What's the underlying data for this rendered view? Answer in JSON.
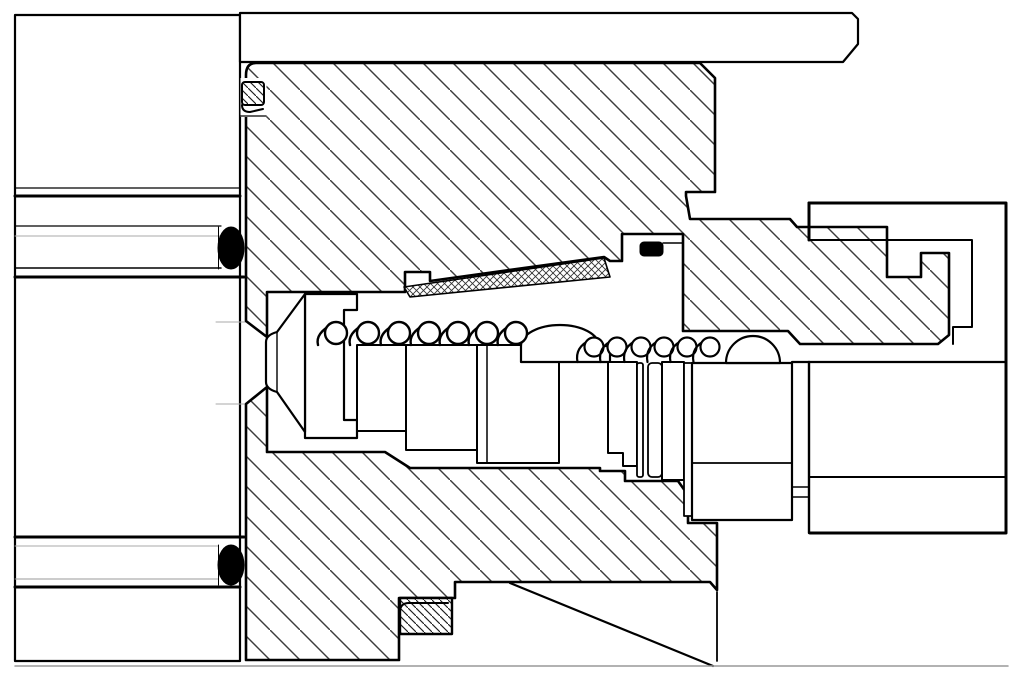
{
  "drawing": {
    "canvas": {
      "width": 1024,
      "height": 681,
      "background": "#ffffff"
    },
    "colors": {
      "line": "#000000",
      "hatch": "#3c3c3c",
      "light_gray": "#aaaaaa",
      "frame_gray": "#999999",
      "seal_black": "#000000",
      "paper": "#ffffff"
    },
    "springs": [
      {
        "name": "spring-left",
        "cy": 333,
        "r": 11,
        "base_y": 345,
        "cx": [
          336,
          368,
          399,
          429,
          458,
          487,
          516
        ],
        "stroke_w": 2.4
      },
      {
        "name": "spring-right",
        "cy": 347,
        "r": 9.5,
        "base_y": 362,
        "cx": [
          594,
          617,
          641,
          664,
          687,
          710
        ],
        "stroke_w": 2.2
      }
    ],
    "parts": [
      {
        "name": "manifold-block",
        "kind": "path",
        "d": "M15,15 H240 V661 H15 Z",
        "fill": "#ffffff",
        "stroke": "#000000",
        "w": 2.2
      },
      {
        "name": "manifold-line-1",
        "kind": "line",
        "x1": 15,
        "y1": 188,
        "x2": 240,
        "y2": 188,
        "stroke": "#000000",
        "w": 1.2
      },
      {
        "name": "manifold-line-2",
        "kind": "line",
        "x1": 15,
        "y1": 196,
        "x2": 240,
        "y2": 196,
        "stroke": "#000000",
        "w": 3
      },
      {
        "name": "manifold-line-3",
        "kind": "line",
        "x1": 15,
        "y1": 226,
        "x2": 221,
        "y2": 226,
        "stroke": "#000000",
        "w": 1.2
      },
      {
        "name": "manifold-line-4",
        "kind": "line",
        "x1": 15,
        "y1": 236,
        "x2": 221,
        "y2": 236,
        "stroke": "#aaaaaa",
        "w": 1
      },
      {
        "name": "manifold-line-5",
        "kind": "line",
        "x1": 15,
        "y1": 268,
        "x2": 221,
        "y2": 268,
        "stroke": "#000000",
        "w": 1.5
      },
      {
        "name": "manifold-line-6",
        "kind": "line",
        "x1": 15,
        "y1": 277,
        "x2": 244,
        "y2": 277,
        "stroke": "#000000",
        "w": 3
      },
      {
        "name": "manifold-line-7",
        "kind": "line",
        "x1": 15,
        "y1": 537,
        "x2": 244,
        "y2": 537,
        "stroke": "#000000",
        "w": 3
      },
      {
        "name": "manifold-line-8",
        "kind": "line",
        "x1": 15,
        "y1": 546,
        "x2": 218,
        "y2": 546,
        "stroke": "#aaaaaa",
        "w": 1
      },
      {
        "name": "manifold-line-9",
        "kind": "line",
        "x1": 15,
        "y1": 579,
        "x2": 218,
        "y2": 579,
        "stroke": "#999999",
        "w": 1
      },
      {
        "name": "manifold-line-10",
        "kind": "line",
        "x1": 15,
        "y1": 587,
        "x2": 240,
        "y2": 587,
        "stroke": "#000000",
        "w": 3
      },
      {
        "name": "port-edge-upper",
        "kind": "line",
        "x1": 216,
        "y1": 322,
        "x2": 246,
        "y2": 322,
        "stroke": "#aaaaaa",
        "w": 1
      },
      {
        "name": "port-edge-lower",
        "kind": "line",
        "x1": 216,
        "y1": 404,
        "x2": 246,
        "y2": 404,
        "stroke": "#aaaaaa",
        "w": 1
      },
      {
        "name": "oring-groove-upper",
        "kind": "line",
        "x1": 218.5,
        "y1": 227,
        "x2": 218.5,
        "y2": 269,
        "stroke": "#000000",
        "w": 1
      },
      {
        "name": "oring-groove-lower",
        "kind": "line",
        "x1": 218.5,
        "y1": 545,
        "x2": 218.5,
        "y2": 585,
        "stroke": "#000000",
        "w": 1
      },
      {
        "name": "top-cover-strip",
        "kind": "path",
        "d": "M240,13 H852 L858,19 V44 L843,62 H240 Z",
        "fill": "#ffffff",
        "stroke": "#000000",
        "w": 2.2
      },
      {
        "name": "valve-body-upper-half",
        "kind": "path",
        "d": "M256,63 H700 L715,78 V192 H686 V196 L690,219 H790 L797,227 H887 V277 H921 V253 H949 V335 L938,344 H800 L788,331 H683 V234 H622 V261 H610 L604,257 L430,281 V272 H405 V292 H267 V337 L246,321 V75 Q246,63 256,63 Z",
        "fill": "url(#hatchMain)",
        "stroke": "#000000",
        "w": 2.6
      },
      {
        "name": "valve-body-lower-half",
        "kind": "path",
        "d": "M246,404 L267,387 V452 H385 L410,468 H600 V471 H625 V481 H678 L688,495 V523 H717 V590 L710,582 H455 V598 H399 V660 H246 Z",
        "fill": "url(#hatchMain)",
        "stroke": "#000000",
        "w": 2.6
      },
      {
        "name": "bore-curve-edge",
        "kind": "line",
        "x1": 510,
        "y1": 583,
        "x2": 713,
        "y2": 666,
        "stroke": "#000000",
        "w": 2.2
      },
      {
        "name": "body-rear-edge",
        "kind": "line",
        "x1": 717,
        "y1": 592,
        "x2": 717,
        "y2": 661,
        "stroke": "#000000",
        "w": 1.8
      },
      {
        "name": "baseline",
        "kind": "line",
        "x1": 15,
        "y1": 666,
        "x2": 1008,
        "y2": 666,
        "stroke": "#999999",
        "w": 1.5
      },
      {
        "name": "spring-cup",
        "kind": "path",
        "d": "M305,294 H357 V310 H344 V420 H357 V438 H305 Z",
        "fill": "#ffffff",
        "stroke": "#000000",
        "w": 2.2
      },
      {
        "name": "poppet",
        "kind": "path",
        "d": "M305,294 L277,332 Q266,335 266,342 V382 Q266,389 277,392 L305,432 Z",
        "fill": "#ffffff",
        "stroke": "#000000",
        "w": 2.2
      },
      {
        "name": "poppet-tip-edge",
        "kind": "line",
        "x1": 277,
        "y1": 332,
        "x2": 277,
        "y2": 392,
        "stroke": "#000000",
        "w": 1.4
      },
      {
        "name": "spool-segment-1",
        "kind": "rect",
        "x": 357,
        "y": 345,
        "width": 49,
        "height": 86,
        "fill": "#ffffff",
        "stroke": "#000000",
        "w": 2
      },
      {
        "name": "spool-segment-2",
        "kind": "rect",
        "x": 406,
        "y": 345,
        "width": 71,
        "height": 105,
        "fill": "#ffffff",
        "stroke": "#000000",
        "w": 2
      },
      {
        "name": "spool-segment-3",
        "kind": "rect",
        "x": 477,
        "y": 345,
        "width": 82,
        "height": 118,
        "fill": "#ffffff",
        "stroke": "#000000",
        "w": 2
      },
      {
        "name": "spool-rib-edge",
        "kind": "line",
        "x1": 487,
        "y1": 345,
        "x2": 487,
        "y2": 463,
        "stroke": "#000000",
        "w": 1.5
      },
      {
        "name": "spool-dome-left",
        "kind": "path",
        "d": "M521,346 A39,21 0 0 1 599,346 H610 V362 H521 Z",
        "fill": "#ffffff",
        "stroke": "#000000",
        "w": 2.2
      },
      {
        "name": "spool-segment-4",
        "kind": "path",
        "d": "M608,362 H637 V466 H623 V453 H608 Z",
        "fill": "#ffffff",
        "stroke": "#000000",
        "w": 2
      },
      {
        "name": "retaining-ring-a",
        "kind": "rect",
        "x": 637,
        "y": 363,
        "width": 6,
        "height": 114,
        "rx": 2,
        "fill": "#ffffff",
        "stroke": "#000000",
        "w": 1.8
      },
      {
        "name": "retaining-ring-b",
        "kind": "rect",
        "x": 648,
        "y": 363,
        "width": 14,
        "height": 114,
        "rx": 4,
        "fill": "#ffffff",
        "stroke": "#000000",
        "w": 1.8
      },
      {
        "name": "spool-segment-5",
        "kind": "rect",
        "x": 662,
        "y": 362,
        "width": 22,
        "height": 118,
        "fill": "#ffffff",
        "stroke": "#000000",
        "w": 2
      },
      {
        "name": "spool-sleeve-strip",
        "kind": "rect",
        "x": 684,
        "y": 363,
        "width": 8,
        "height": 153,
        "fill": "#ffffff",
        "stroke": "#000000",
        "w": 1.8
      },
      {
        "name": "spool-segment-6",
        "kind": "path",
        "d": "M692,363 H792 V520 H692 Z",
        "fill": "#ffffff",
        "stroke": "#000000",
        "w": 2.2
      },
      {
        "name": "spool-segment-6-step",
        "kind": "line",
        "x1": 692,
        "y1": 463,
        "x2": 792,
        "y2": 463,
        "stroke": "#000000",
        "w": 1.8
      },
      {
        "name": "spool-dome-right",
        "kind": "path",
        "d": "M726,363 A27,27 0 0 1 780,363 Z",
        "fill": "#ffffff",
        "stroke": "#000000",
        "w": 2.2
      },
      {
        "name": "metering-wedge",
        "kind": "path",
        "d": "M404,287 L604,258 L610,277 L410,297 Z",
        "fill": "url(#crossFine)",
        "stroke": "#000000",
        "w": 1.6
      },
      {
        "name": "wedge-step-edge",
        "kind": "path",
        "d": "M405,272 H430 V281",
        "fill": "none",
        "stroke": "#000000",
        "w": 1.4
      },
      {
        "name": "upper-seal-groove",
        "kind": "rect",
        "x": 240.5,
        "y": 78,
        "width": 26,
        "height": 39,
        "fill": "#ffffff",
        "stroke": "none",
        "w": 0
      },
      {
        "name": "upper-backup-ring",
        "kind": "rect",
        "x": 242,
        "y": 82,
        "width": 22,
        "height": 23,
        "rx": 3,
        "fill": "url(#hatchFine)",
        "stroke": "#000000",
        "w": 2
      },
      {
        "name": "upper-backup-ring-lip",
        "kind": "path",
        "d": "M242,105 Q242,112 250,112 L263,109",
        "fill": "none",
        "stroke": "#000000",
        "w": 2
      },
      {
        "name": "upper-seal-groove-edge",
        "kind": "line",
        "x1": 240.5,
        "y1": 116,
        "x2": 266,
        "y2": 116,
        "stroke": "#000000",
        "w": 1.2
      },
      {
        "name": "spool-oring-groove",
        "kind": "path",
        "d": "M622,261 V234 H683 V243 H663",
        "fill": "none",
        "stroke": "#000000",
        "w": 1.5
      },
      {
        "name": "spool-oring",
        "kind": "rect",
        "x": 640,
        "y": 242,
        "width": 23,
        "height": 14,
        "rx": 4,
        "fill": "#000000",
        "stroke": "#000000",
        "w": 1
      },
      {
        "name": "lower-backup-ring",
        "kind": "rect",
        "x": 400,
        "y": 598,
        "width": 52,
        "height": 36,
        "fill": "url(#hatchFine)",
        "stroke": "#000000",
        "w": 2.4
      },
      {
        "name": "lower-backup-ring-lip",
        "kind": "path",
        "d": "M400,612 Q400,603 409,603 H448",
        "fill": "none",
        "stroke": "#000000",
        "w": 2
      },
      {
        "name": "oring-upper",
        "kind": "ellipse",
        "cx": 231,
        "cy": 248,
        "rx": 13,
        "ry": 21,
        "fill": "#000000",
        "stroke": "#000000",
        "w": 1
      },
      {
        "name": "oring-lower",
        "kind": "ellipse",
        "cx": 231,
        "cy": 565,
        "rx": 13,
        "ry": 20,
        "fill": "#000000",
        "stroke": "#000000",
        "w": 1
      },
      {
        "name": "fitting-outline",
        "kind": "path",
        "d": "M809,203 H1006 V533 H810",
        "fill": "none",
        "stroke": "#000000",
        "w": 3
      },
      {
        "name": "fitting-face-upper",
        "kind": "line",
        "x1": 809,
        "y1": 203,
        "x2": 809,
        "y2": 240,
        "stroke": "#000000",
        "w": 3
      },
      {
        "name": "fitting-face-lower",
        "kind": "line",
        "x1": 809,
        "y1": 362,
        "x2": 809,
        "y2": 533,
        "stroke": "#000000",
        "w": 2.4
      },
      {
        "name": "fitting-thread-profile",
        "kind": "path",
        "d": "M809,240 H972 V327 H953 V344",
        "fill": "none",
        "stroke": "#000000",
        "w": 2
      },
      {
        "name": "fitting-bore-top",
        "kind": "line",
        "x1": 792,
        "y1": 362,
        "x2": 1006,
        "y2": 362,
        "stroke": "#000000",
        "w": 2.2
      },
      {
        "name": "fitting-bore-step",
        "kind": "line",
        "x1": 809,
        "y1": 477,
        "x2": 1006,
        "y2": 477,
        "stroke": "#000000",
        "w": 2
      },
      {
        "name": "fitting-joint-edge-1",
        "kind": "line",
        "x1": 792,
        "y1": 487,
        "x2": 809,
        "y2": 487,
        "stroke": "#000000",
        "w": 1.4
      },
      {
        "name": "fitting-joint-edge-2",
        "kind": "line",
        "x1": 792,
        "y1": 497,
        "x2": 809,
        "y2": 497,
        "stroke": "#000000",
        "w": 1.4
      }
    ]
  }
}
